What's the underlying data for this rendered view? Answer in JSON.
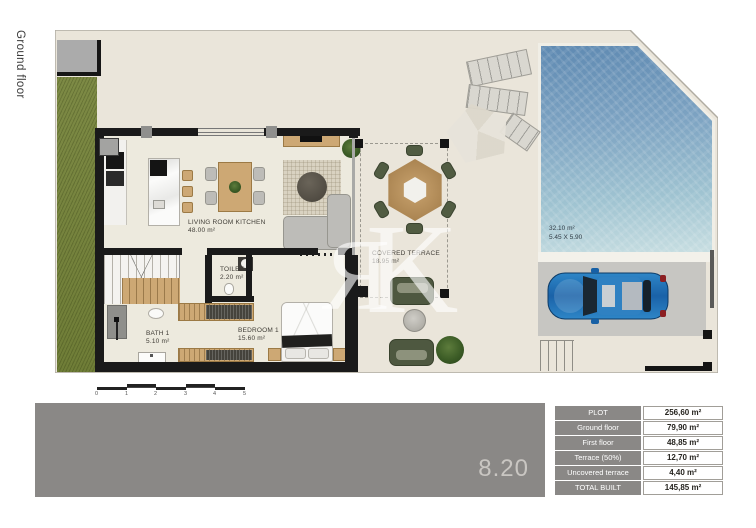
{
  "sheet": {
    "floor_label": "Ground floor",
    "dimension_label": "8.20",
    "watermark_letters": [
      "R",
      "K"
    ]
  },
  "plan": {
    "living_room": {
      "name": "LIVING ROOM KITCHEN",
      "area": "48.00 m²"
    },
    "toilet": {
      "name": "TOILET",
      "area": "2.20 m²"
    },
    "bath": {
      "name": "BATH 1",
      "area": "5.10 m²"
    },
    "bedroom": {
      "name": "BEDROOM 1",
      "area": "15.60 m²"
    },
    "covered_terrace": {
      "name": "COVERED TERRACE",
      "area": "18.95 m²"
    },
    "pool": {
      "area": "32.10 m²",
      "dimensions": "5.45 X 5.90"
    },
    "scale": {
      "ticks": [
        "0",
        "1",
        "2",
        "3",
        "4",
        "5"
      ]
    }
  },
  "summary_table": {
    "rows": [
      {
        "label": "PLOT",
        "value": "256,60 m²"
      },
      {
        "label": "Ground floor",
        "value": "79,90 m²"
      },
      {
        "label": "First floor",
        "value": "48,85 m²"
      },
      {
        "label": "Terrace (50%)",
        "value": "12,70 m²"
      },
      {
        "label": "Uncovered terrace",
        "value": "4,40 m²"
      },
      {
        "label": "TOTAL BUILT",
        "value": "145,85 m²"
      }
    ]
  },
  "colors": {
    "accent_gray": "#8a8886",
    "pool_blue": "#7da3c2",
    "grass_green": "#7a8742",
    "wall_black": "#1a1a1a",
    "wood": "#cda874",
    "outdoor_green": "#4e5840",
    "car_blue": "#1d6cb0"
  }
}
